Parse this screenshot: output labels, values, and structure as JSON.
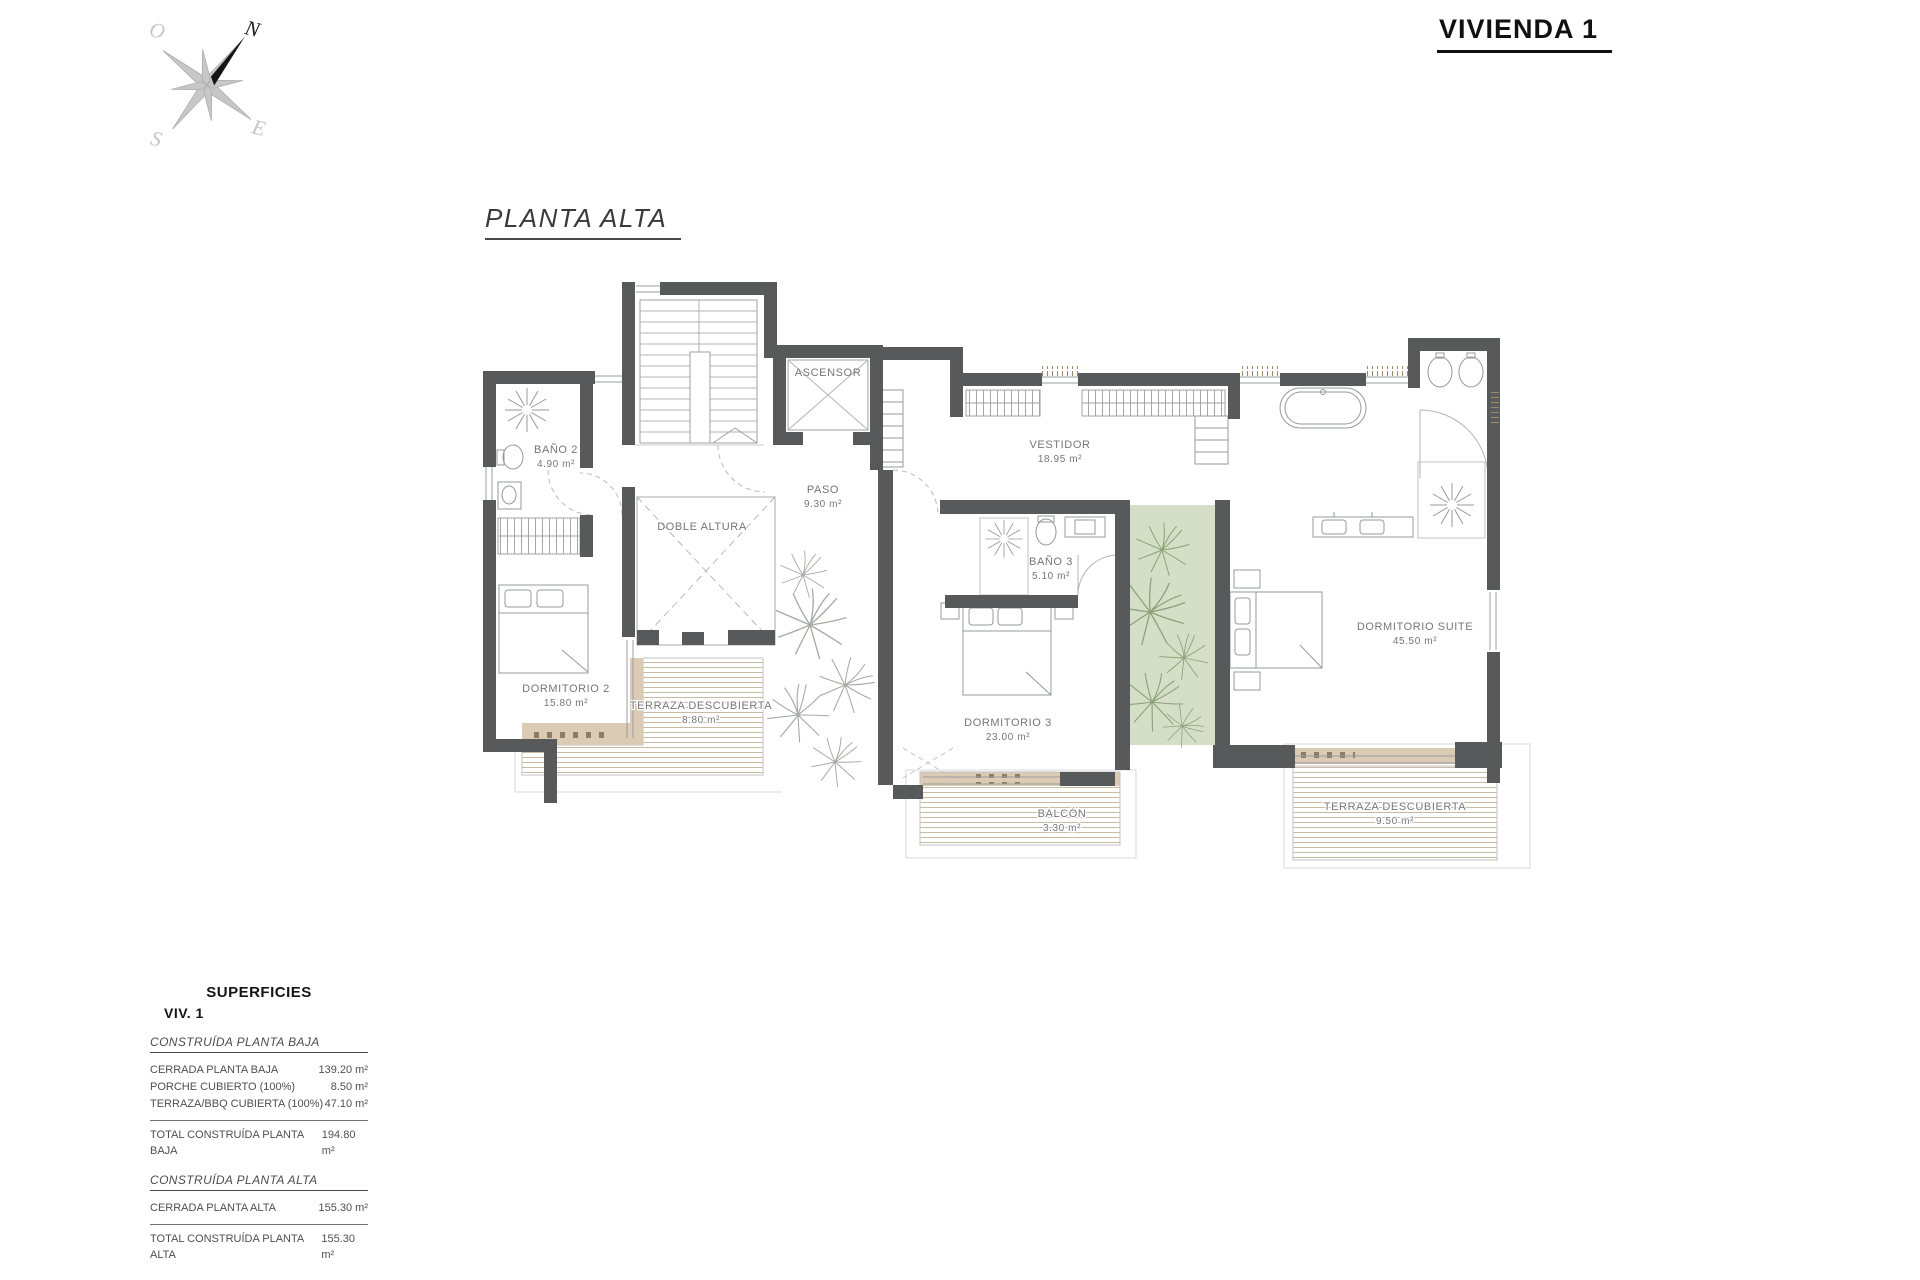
{
  "header": {
    "title": "VIVIENDA 1"
  },
  "plan": {
    "title": "PLANTA ALTA",
    "compass": {
      "n": "N",
      "s": "S",
      "e": "E",
      "w": "O"
    },
    "rooms": {
      "bano2": {
        "name": "BAÑO 2",
        "area": "4.90 m²"
      },
      "dorm2": {
        "name": "DORMITORIO 2",
        "area": "15.80 m²"
      },
      "doble_altura": {
        "name": "DOBLE ALTURA"
      },
      "paso": {
        "name": "PASO",
        "area": "9.30 m²"
      },
      "ascensor": {
        "name": "ASCENSOR"
      },
      "vestidor": {
        "name": "VESTIDOR",
        "area": "18.95 m²"
      },
      "bano3": {
        "name": "BAÑO 3",
        "area": "5.10 m²"
      },
      "dorm3": {
        "name": "DORMITORIO 3",
        "area": "23.00 m²"
      },
      "suite": {
        "name": "DORMITORIO SUITE",
        "area": "45.50 m²"
      },
      "terraza_oeste": {
        "name": "TERRAZA DESCUBIERTA",
        "area": "8.80 m²"
      },
      "balcon": {
        "name": "BALCÓN",
        "area": "3.30 m²"
      },
      "terraza_este": {
        "name": "TERRAZA DESCUBIERTA",
        "area": "9.50 m²"
      }
    }
  },
  "surfaces": {
    "title": "SUPERFICIES",
    "subtitle": "VIV. 1",
    "planta_baja": {
      "heading": "CONSTRUÍDA PLANTA BAJA",
      "rows": [
        {
          "label": "CERRADA PLANTA BAJA",
          "value": "139.20 m²"
        },
        {
          "label": "PORCHE CUBIERTO (100%)",
          "value": "8.50 m²"
        },
        {
          "label": "TERRAZA/BBQ CUBIERTA (100%)",
          "value": "47.10 m²"
        }
      ],
      "total": {
        "label": "TOTAL CONSTRUÍDA PLANTA BAJA",
        "value": "194.80 m²"
      }
    },
    "planta_alta": {
      "heading": "CONSTRUÍDA PLANTA ALTA",
      "rows": [
        {
          "label": "CERRADA PLANTA ALTA",
          "value": "155.30 m²"
        }
      ],
      "total": {
        "label": "TOTAL CONSTRUÍDA PLANTA ALTA",
        "value": "155.30 m²"
      }
    },
    "grand_total": {
      "label": "TOTAL CONSTRUÍDA VIVIENDA 1",
      "value": "350.10 m²"
    }
  },
  "colors": {
    "wall": "#58595b",
    "wood_band": "#dbcab4",
    "deck_line": "#c3b298",
    "patio_green": "#d5dfc8",
    "plant_green": "#8ba276",
    "highlight_bg": "#b1b2b4"
  }
}
